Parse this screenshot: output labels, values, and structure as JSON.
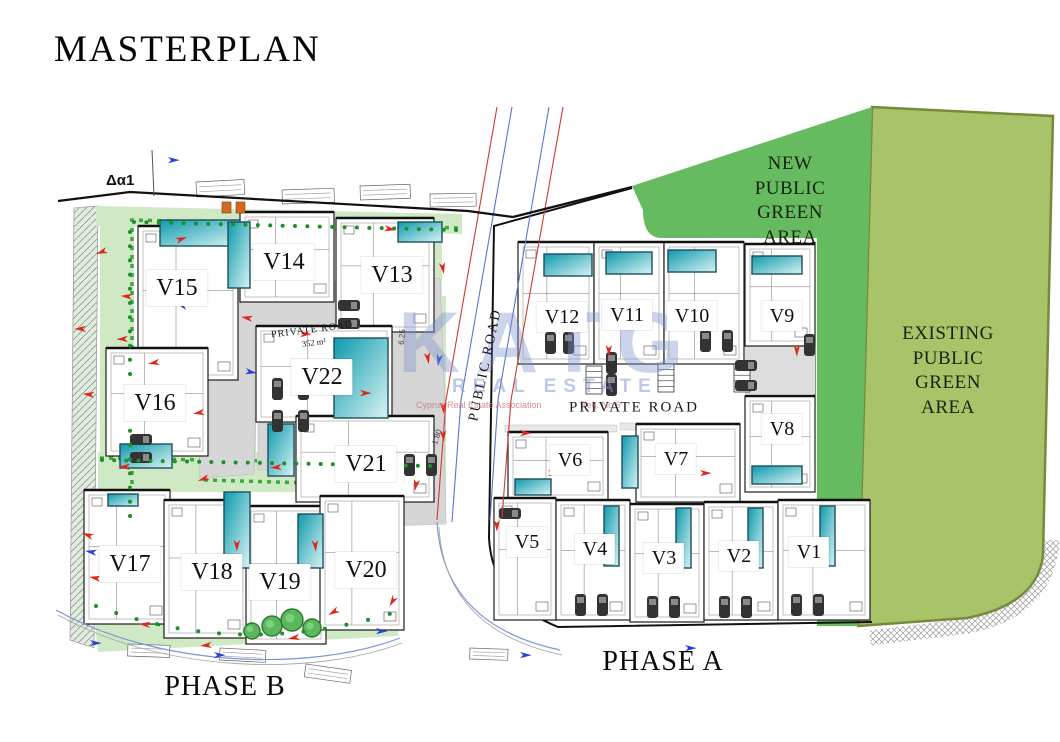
{
  "title": "MASTERPLAN",
  "phase_labels": {
    "phase_a": "PHASE A",
    "phase_b": "PHASE B"
  },
  "green_areas": {
    "new_public": {
      "lines": [
        "NEW",
        "PUBLIC",
        "GREEN",
        "AREA"
      ],
      "fill": "#66bb60"
    },
    "existing_public": {
      "lines": [
        "EXISTING",
        "PUBLIC",
        "GREEN",
        "AREA"
      ],
      "fill": "#a9c468",
      "border": "#77893d"
    }
  },
  "roads": {
    "public_road_label": "PUBLIC ROAD",
    "phase_a_private_road_label": "PRIVATE ROAD",
    "phase_b_private_road_label": "PRIVATE ROAD",
    "phase_b_private_road_area": "352 m²"
  },
  "annotations": {
    "survey_point": "Δα1",
    "dim_left": "6.25",
    "dim_right": "1.80"
  },
  "watermark": {
    "brand": "KATG",
    "subtitle": "REAL ESTATE",
    "fine_print_left": "Cyprus Real Estate Association",
    "fine_print_right": "Reg. No 6"
  },
  "villas": {
    "phase_a": [
      {
        "id": "V1",
        "x": 809,
        "y": 552
      },
      {
        "id": "V2",
        "x": 739,
        "y": 556
      },
      {
        "id": "V3",
        "x": 664,
        "y": 558
      },
      {
        "id": "V4",
        "x": 595,
        "y": 549
      },
      {
        "id": "V5",
        "x": 527,
        "y": 542
      },
      {
        "id": "V6",
        "x": 570,
        "y": 460
      },
      {
        "id": "V7",
        "x": 676,
        "y": 459
      },
      {
        "id": "V8",
        "x": 782,
        "y": 429
      },
      {
        "id": "V9",
        "x": 782,
        "y": 316
      },
      {
        "id": "V10",
        "x": 692,
        "y": 316
      },
      {
        "id": "V11",
        "x": 627,
        "y": 315
      },
      {
        "id": "V12",
        "x": 562,
        "y": 317
      }
    ],
    "phase_b": [
      {
        "id": "V13",
        "x": 392,
        "y": 275
      },
      {
        "id": "V14",
        "x": 284,
        "y": 262
      },
      {
        "id": "V15",
        "x": 177,
        "y": 288
      },
      {
        "id": "V16",
        "x": 155,
        "y": 403
      },
      {
        "id": "V17",
        "x": 130,
        "y": 564
      },
      {
        "id": "V18",
        "x": 212,
        "y": 572
      },
      {
        "id": "V19",
        "x": 280,
        "y": 582
      },
      {
        "id": "V20",
        "x": 366,
        "y": 570
      },
      {
        "id": "V21",
        "x": 366,
        "y": 464
      },
      {
        "id": "V22",
        "x": 322,
        "y": 377
      }
    ]
  },
  "colors": {
    "pool_dark": "#0d9aac",
    "pool_light": "#c9eef0",
    "road_gray": "#d6d6d6",
    "landscape_green": "#cfe9c5",
    "hedge_green": "#2f9e33",
    "marker_red": "#e0261c",
    "marker_blue": "#2b3fd6",
    "boundary_black": "#111111"
  }
}
